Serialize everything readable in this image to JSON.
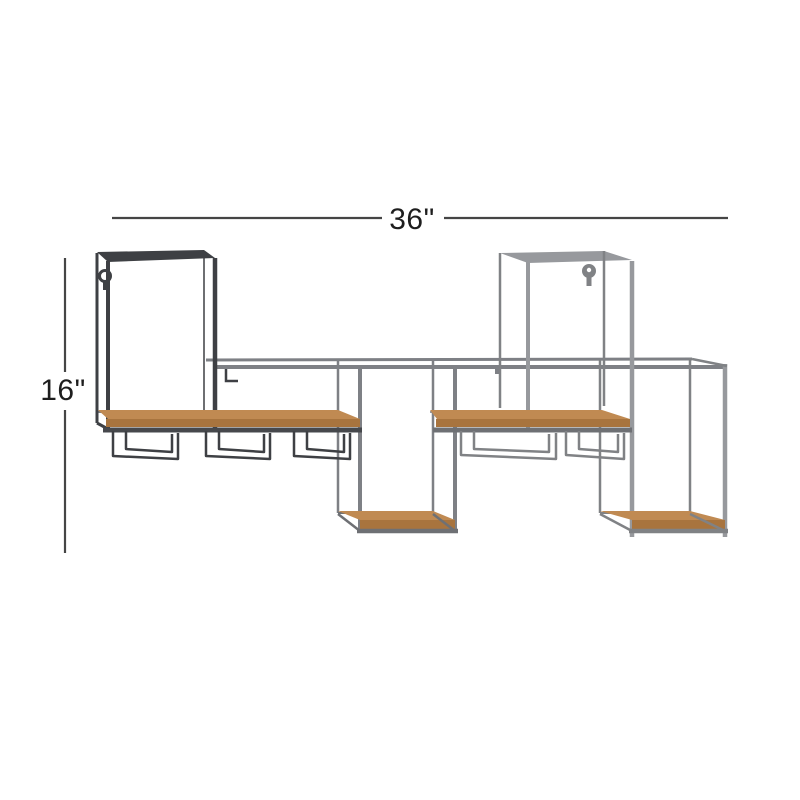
{
  "page": {
    "type": "product-dimensions-diagram",
    "background": "#ffffff"
  },
  "dimensions": {
    "width_label": "36\"",
    "height_label": "16\"",
    "line_color": "#454545",
    "text_color": "#1e1e1e"
  },
  "product": {
    "description": "wall-mounted metal and wood wine rack shelf with four box frames, two long wood shelves, hanging stemware racks and keyhole hangers",
    "colors": {
      "dark_metal": "#3e4044",
      "mid_metal": "#7e8085",
      "light_metal": "#97999d",
      "light_metal_dark": "#808285",
      "wood_top": "#c08a52",
      "wood_front": "#a8743e",
      "shelf_edge_dark": "#46484c",
      "shelf_edge_mid": "#6e7074"
    }
  }
}
